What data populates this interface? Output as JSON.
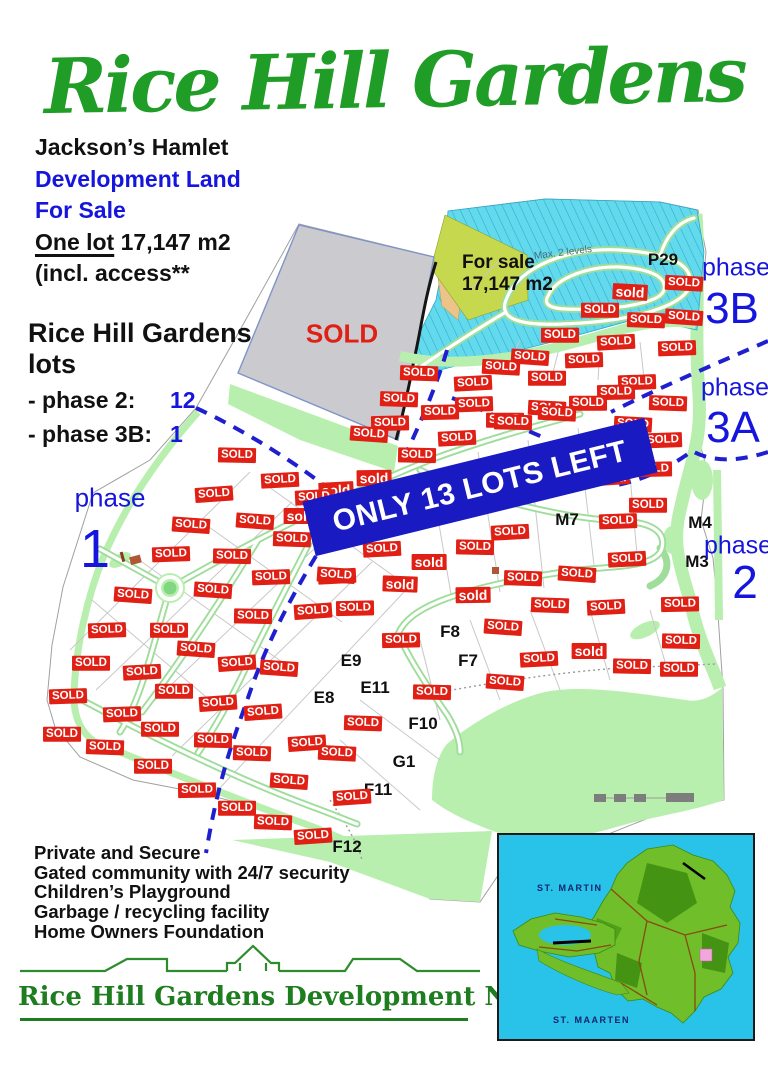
{
  "title": "Rice Hill Gardens",
  "intro": {
    "location": "Jackson’s Hamlet",
    "dev_line1": "Development Land",
    "dev_line2": "For Sale",
    "lot_underlined": "One lot",
    "lot_rest": " 17,147 m2",
    "access_note": "(incl. access**"
  },
  "lots_summary": {
    "heading1": "Rice Hill Gardens",
    "heading2": "lots",
    "rows": [
      {
        "label": "- phase 2:",
        "value": "12"
      },
      {
        "label": "- phase 3B:",
        "value": "1"
      }
    ]
  },
  "map": {
    "banner_text": "ONLY 13 LOTS LEFT",
    "gray_lot_label": "SOLD",
    "for_sale_line1": "For sale",
    "for_sale_line2": "17,147 m2",
    "pond_note": "Max. 2 levels",
    "sold_text": {
      "u": "SOLD",
      "l": "sold"
    },
    "phase_labels": [
      {
        "word": "phase",
        "num": "1",
        "wx": 110,
        "wy": 498,
        "ws": 26,
        "nx": 95,
        "ny": 549,
        "ns": 54
      },
      {
        "word": "phase",
        "num": "2",
        "wx": 738,
        "wy": 546,
        "ws": 25,
        "nx": 745,
        "ny": 582,
        "ns": 46
      },
      {
        "word": "phase",
        "num": "3A",
        "wx": 735,
        "wy": 388,
        "ws": 25,
        "nx": 733,
        "ny": 428,
        "ns": 44
      },
      {
        "word": "phase",
        "num": "3B",
        "wx": 736,
        "wy": 268,
        "ws": 25,
        "nx": 732,
        "ny": 309,
        "ns": 44
      }
    ],
    "lot_labels": [
      {
        "t": "P29",
        "x": 663,
        "y": 260
      },
      {
        "t": "M7",
        "x": 567,
        "y": 520
      },
      {
        "t": "M4",
        "x": 700,
        "y": 523
      },
      {
        "t": "M3",
        "x": 697,
        "y": 562
      },
      {
        "t": "F8",
        "x": 450,
        "y": 632
      },
      {
        "t": "F7",
        "x": 468,
        "y": 661
      },
      {
        "t": "E9",
        "x": 351,
        "y": 661
      },
      {
        "t": "E11",
        "x": 375,
        "y": 688
      },
      {
        "t": "E8",
        "x": 324,
        "y": 698
      },
      {
        "t": "F10",
        "x": 423,
        "y": 724
      },
      {
        "t": "G1",
        "x": 404,
        "y": 762
      },
      {
        "t": "F11",
        "x": 378,
        "y": 790
      },
      {
        "t": "F12",
        "x": 347,
        "y": 847
      }
    ],
    "sold_badges": [
      [
        630,
        292,
        "l"
      ],
      [
        684,
        283,
        "u"
      ],
      [
        600,
        310,
        "u"
      ],
      [
        646,
        320,
        "u"
      ],
      [
        684,
        317,
        "u"
      ],
      [
        560,
        335,
        "u"
      ],
      [
        616,
        342,
        "u"
      ],
      [
        677,
        348,
        "u"
      ],
      [
        530,
        357,
        "u"
      ],
      [
        584,
        360,
        "u"
      ],
      [
        501,
        367,
        "u"
      ],
      [
        419,
        373,
        "u"
      ],
      [
        473,
        383,
        "u"
      ],
      [
        547,
        378,
        "u"
      ],
      [
        637,
        382,
        "u"
      ],
      [
        616,
        392,
        "u"
      ],
      [
        399,
        399,
        "u"
      ],
      [
        588,
        403,
        "u"
      ],
      [
        668,
        403,
        "u"
      ],
      [
        474,
        404,
        "u"
      ],
      [
        547,
        408,
        "u"
      ],
      [
        440,
        412,
        "u"
      ],
      [
        505,
        420,
        "u"
      ],
      [
        390,
        423,
        "u"
      ],
      [
        369,
        434,
        "u"
      ],
      [
        457,
        438,
        "u"
      ],
      [
        663,
        440,
        "u"
      ],
      [
        417,
        455,
        "u"
      ],
      [
        653,
        469,
        "u"
      ],
      [
        612,
        477,
        "l"
      ],
      [
        633,
        424,
        "u"
      ],
      [
        513,
        422,
        "u"
      ],
      [
        557,
        413,
        "u"
      ],
      [
        374,
        478,
        "l"
      ],
      [
        336,
        490,
        "l"
      ],
      [
        301,
        516,
        "l"
      ],
      [
        429,
        562,
        "l"
      ],
      [
        400,
        584,
        "l"
      ],
      [
        473,
        595,
        "l"
      ],
      [
        237,
        455,
        "u"
      ],
      [
        280,
        480,
        "u"
      ],
      [
        214,
        494,
        "u"
      ],
      [
        314,
        497,
        "u"
      ],
      [
        255,
        521,
        "u"
      ],
      [
        191,
        525,
        "u"
      ],
      [
        292,
        539,
        "u"
      ],
      [
        171,
        554,
        "u"
      ],
      [
        232,
        556,
        "u"
      ],
      [
        271,
        577,
        "u"
      ],
      [
        337,
        576,
        "u"
      ],
      [
        133,
        595,
        "u"
      ],
      [
        213,
        590,
        "u"
      ],
      [
        382,
        549,
        "u"
      ],
      [
        336,
        575,
        "u"
      ],
      [
        510,
        532,
        "u"
      ],
      [
        618,
        521,
        "u"
      ],
      [
        648,
        505,
        "u"
      ],
      [
        627,
        559,
        "u"
      ],
      [
        523,
        578,
        "u"
      ],
      [
        577,
        574,
        "u"
      ],
      [
        475,
        547,
        "u"
      ],
      [
        550,
        605,
        "u"
      ],
      [
        606,
        607,
        "u"
      ],
      [
        680,
        604,
        "u"
      ],
      [
        503,
        627,
        "u"
      ],
      [
        401,
        640,
        "u"
      ],
      [
        681,
        641,
        "u"
      ],
      [
        589,
        651,
        "l"
      ],
      [
        539,
        659,
        "u"
      ],
      [
        632,
        666,
        "u"
      ],
      [
        679,
        669,
        "u"
      ],
      [
        505,
        682,
        "u"
      ],
      [
        432,
        692,
        "u"
      ],
      [
        253,
        616,
        "u"
      ],
      [
        355,
        608,
        "u"
      ],
      [
        313,
        611,
        "u"
      ],
      [
        107,
        630,
        "u"
      ],
      [
        169,
        630,
        "u"
      ],
      [
        196,
        649,
        "u"
      ],
      [
        91,
        663,
        "u"
      ],
      [
        237,
        663,
        "u"
      ],
      [
        279,
        668,
        "u"
      ],
      [
        142,
        672,
        "u"
      ],
      [
        174,
        691,
        "u"
      ],
      [
        68,
        696,
        "u"
      ],
      [
        218,
        703,
        "u"
      ],
      [
        263,
        712,
        "u"
      ],
      [
        122,
        714,
        "u"
      ],
      [
        160,
        729,
        "u"
      ],
      [
        62,
        734,
        "u"
      ],
      [
        213,
        740,
        "u"
      ],
      [
        252,
        753,
        "u"
      ],
      [
        105,
        747,
        "u"
      ],
      [
        153,
        766,
        "u"
      ],
      [
        197,
        790,
        "u"
      ],
      [
        289,
        781,
        "u"
      ],
      [
        237,
        808,
        "u"
      ],
      [
        273,
        822,
        "u"
      ],
      [
        313,
        836,
        "u"
      ],
      [
        363,
        723,
        "u"
      ],
      [
        307,
        743,
        "u"
      ],
      [
        337,
        753,
        "u"
      ],
      [
        352,
        797,
        "u"
      ]
    ]
  },
  "amenities": [
    "Private and Secure",
    "Gated community with 24/7 security",
    "Children’s Playground",
    "Garbage / recycling facility",
    "Home Owners Foundation"
  ],
  "company": "Rice Hill Gardens Development N.V.",
  "inset": {
    "top_label": "ST.  MARTIN",
    "bottom_label": "ST.  MAARTEN"
  },
  "colors": {
    "title_green": "#1f9d26",
    "blue": "#1515dd",
    "badge_red": "#e02015",
    "banner_blue": "#1a1ac2",
    "pond": "#62d9ec",
    "grass": "#b9efae",
    "gray_lot": "#cbcbcf"
  }
}
